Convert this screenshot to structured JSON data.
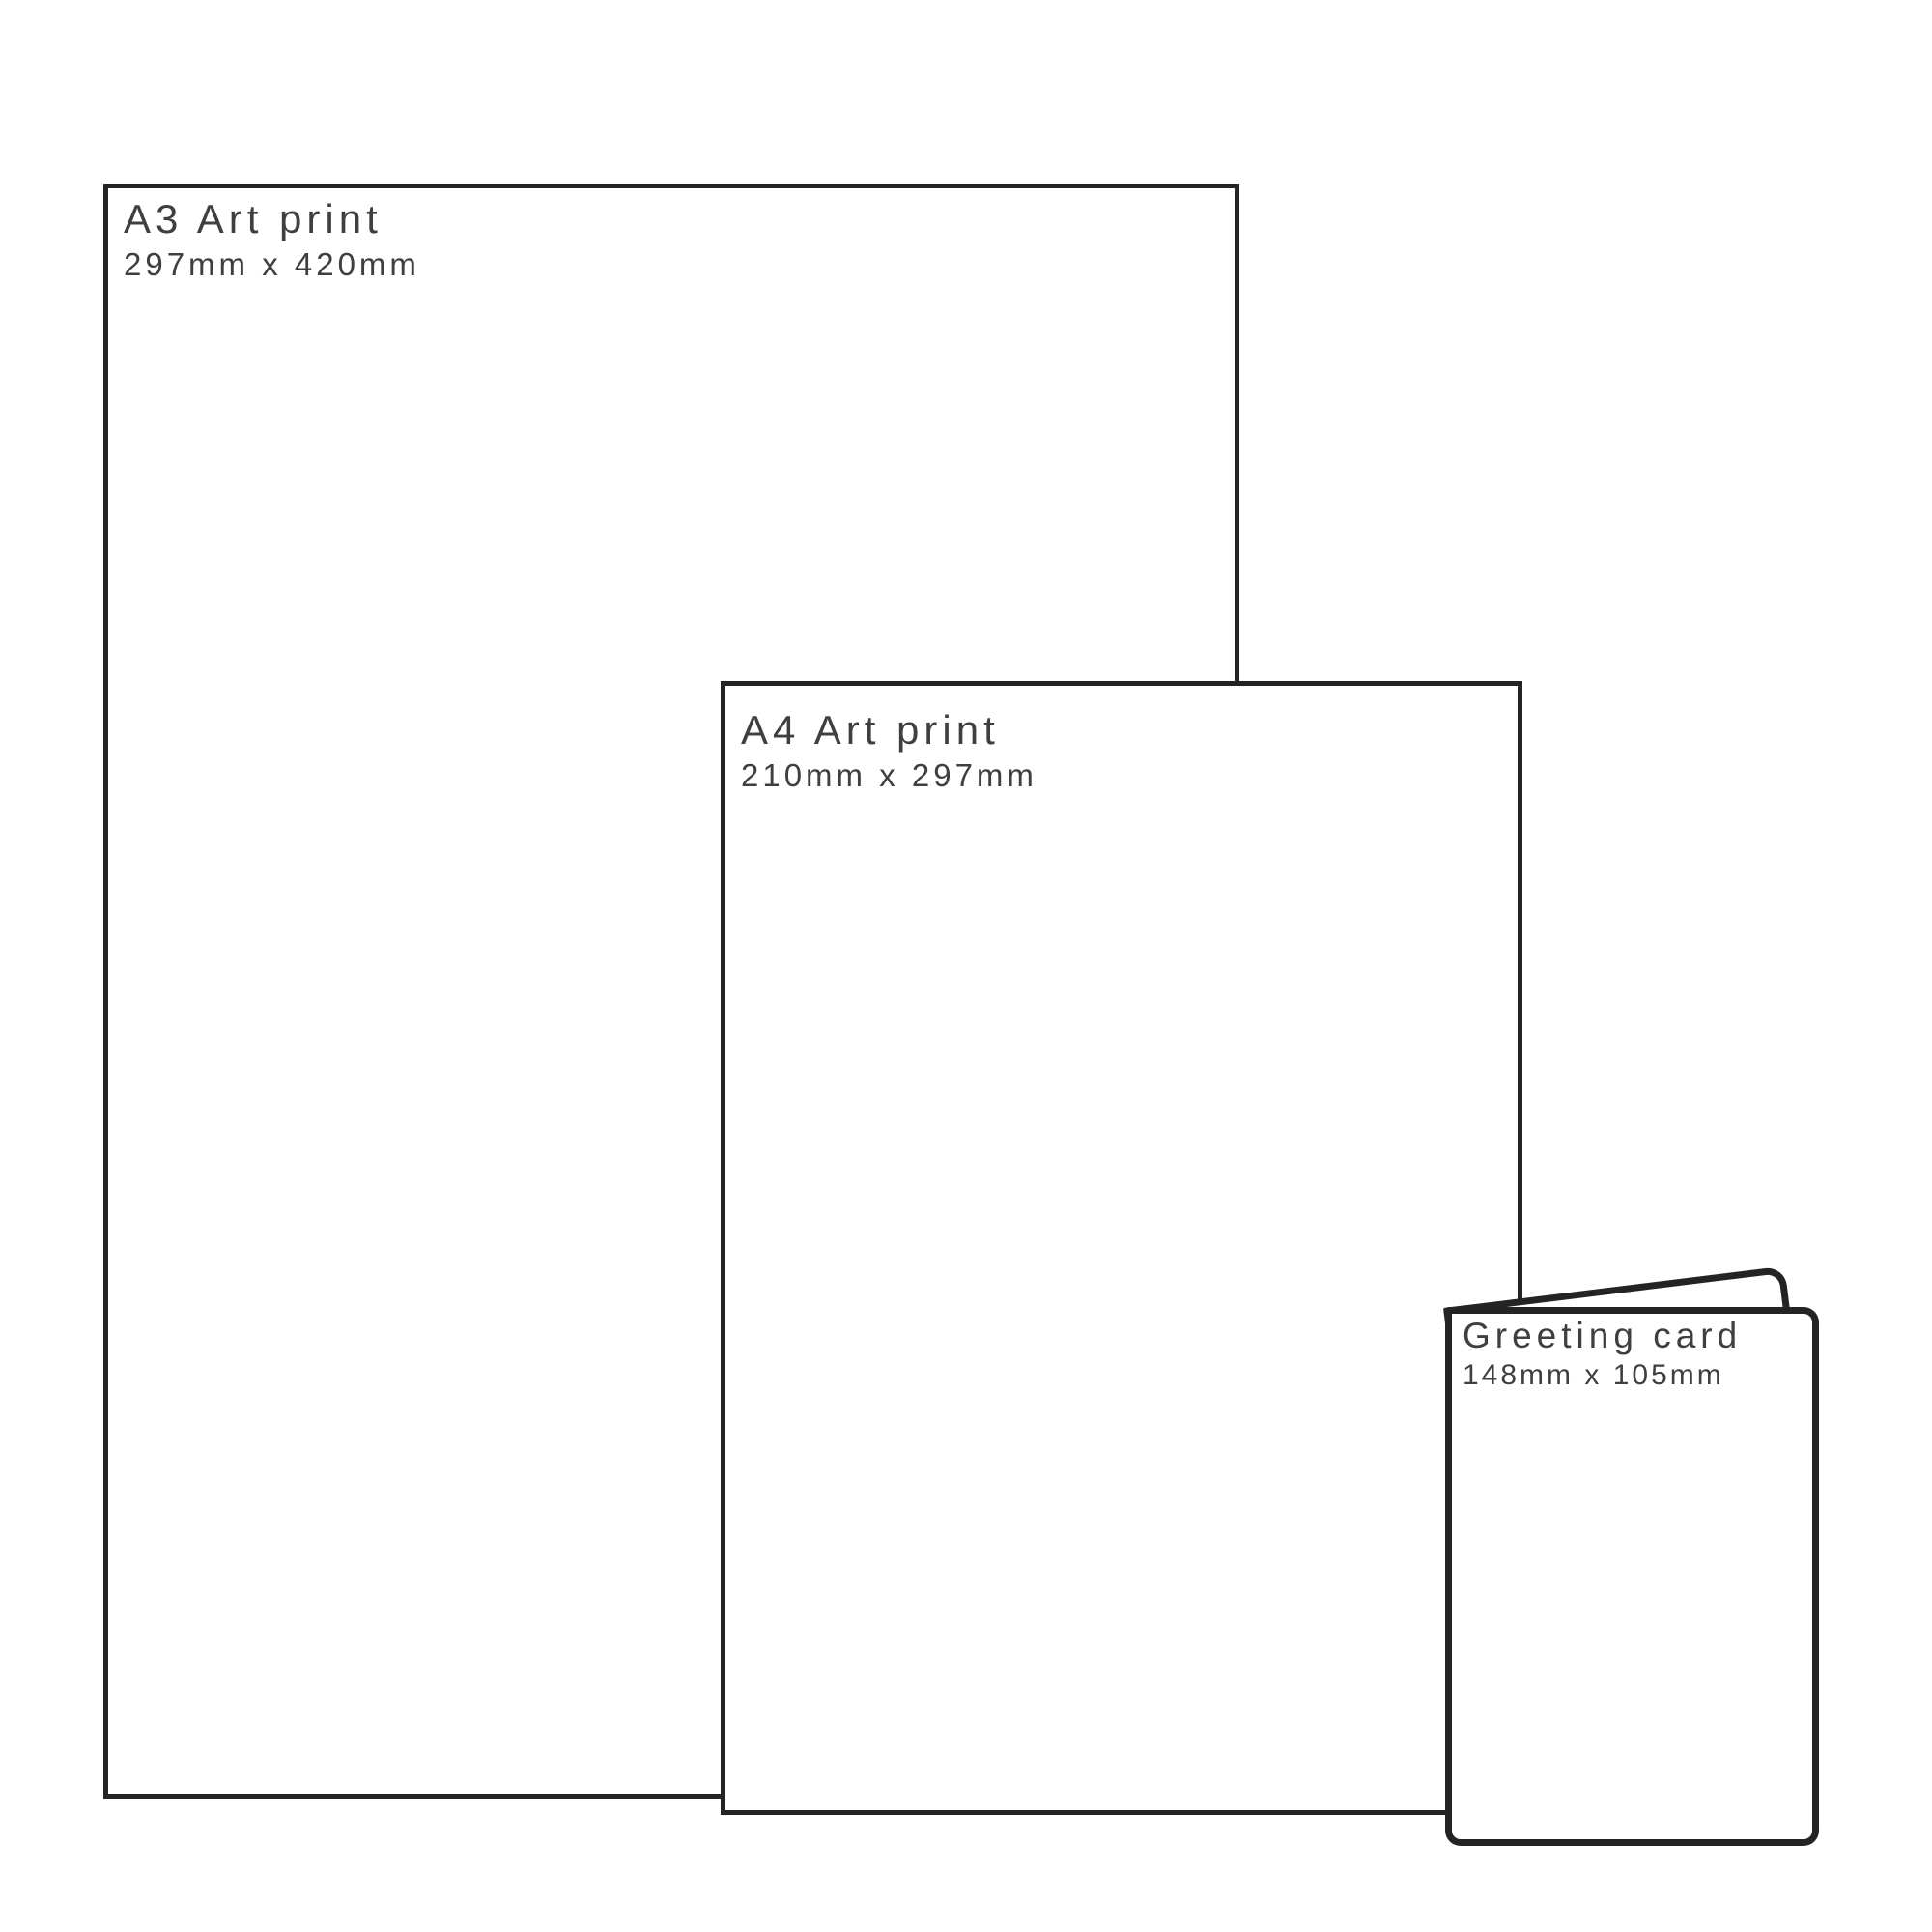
{
  "diagram": {
    "items": [
      {
        "id": "a3",
        "title": "A3 Art print",
        "dimensions": "297mm x 420mm"
      },
      {
        "id": "a4",
        "title": "A4 Art print",
        "dimensions": "210mm x 297mm"
      },
      {
        "id": "card",
        "title": "Greeting card",
        "dimensions": "148mm x 105mm"
      }
    ],
    "colors": {
      "outline": "#242424",
      "text": "#3f3f3f",
      "background": "#ffffff"
    }
  }
}
